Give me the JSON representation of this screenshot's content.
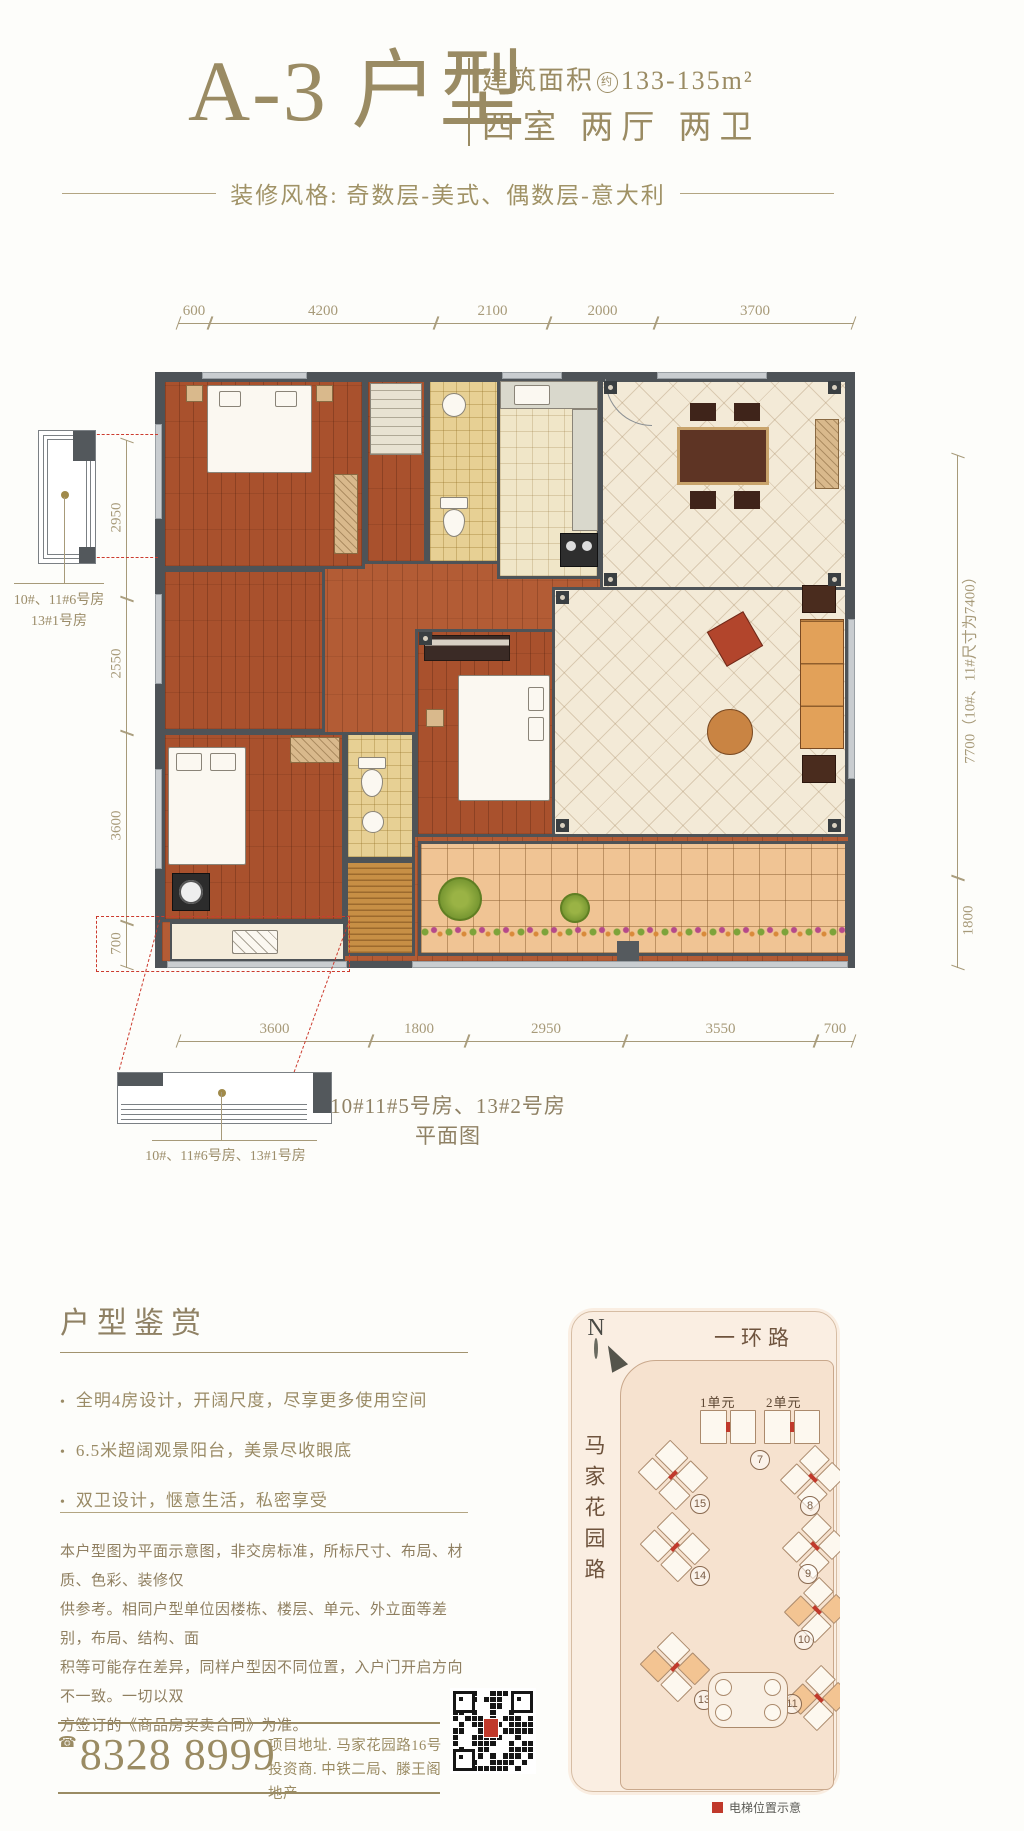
{
  "header": {
    "title": "A-3 户型",
    "area_label": "建筑面积",
    "area_circle": "约",
    "area_value": "133-135m²",
    "layout_text": "四室 两厅 两卫",
    "style_line": "装修风格: 奇数层-美式、偶数层-意大利"
  },
  "plan": {
    "dims_top": [
      "600",
      "4200",
      "2100",
      "2000",
      "3700"
    ],
    "dims_left": [
      "2950",
      "2550",
      "3600",
      "700"
    ],
    "dims_right": [
      "7700（10#、11#尺寸为7400）",
      "1800"
    ],
    "dims_bottom": [
      "3600",
      "1800",
      "2950",
      "3550",
      "700"
    ],
    "caption": "10#11#5号房、13#2号房平面图",
    "balcony_label_top_line1": "10#、11#6号房",
    "balcony_label_top_line2": "13#1号房",
    "balcony_label_bottom": "10#、11#6号房、13#1号房"
  },
  "features": {
    "title": "户型鉴赏",
    "items": [
      "全明4房设计，开阔尺度，尽享更多使用空间",
      "6.5米超阔观景阳台，美景尽收眼底",
      "双卫设计，惬意生活，私密享受"
    ]
  },
  "disclaimer": {
    "lines": [
      "本户型图为平面示意图，非交房标准，所标尺寸、布局、材质、色彩、装修仅",
      "供参考。相同户型单位因楼栋、楼层、单元、外立面等差别，布局、结构、面",
      "积等可能存在差异，同样户型因不同位置，入户门开启方向不一致。一切以双",
      "方签订的《商品房买卖合同》为准。"
    ]
  },
  "contact": {
    "phone_icon": "☎",
    "phone": "8328 8999",
    "address_line1": "项目地址. 马家花园路16号",
    "address_line2": "投资商. 中铁二局、滕王阁地产"
  },
  "sitemap": {
    "north": "N",
    "road_top": "一环路",
    "road_left": "马家花园路",
    "unit_labels": [
      "1单元",
      "2单元"
    ],
    "buildings": [
      {
        "num": "7"
      },
      {
        "num": "8"
      },
      {
        "num": "9"
      },
      {
        "num": "10"
      },
      {
        "num": "11"
      },
      {
        "num": "13"
      },
      {
        "num": "14"
      },
      {
        "num": "15"
      }
    ],
    "legend": "电梯位置示意"
  }
}
